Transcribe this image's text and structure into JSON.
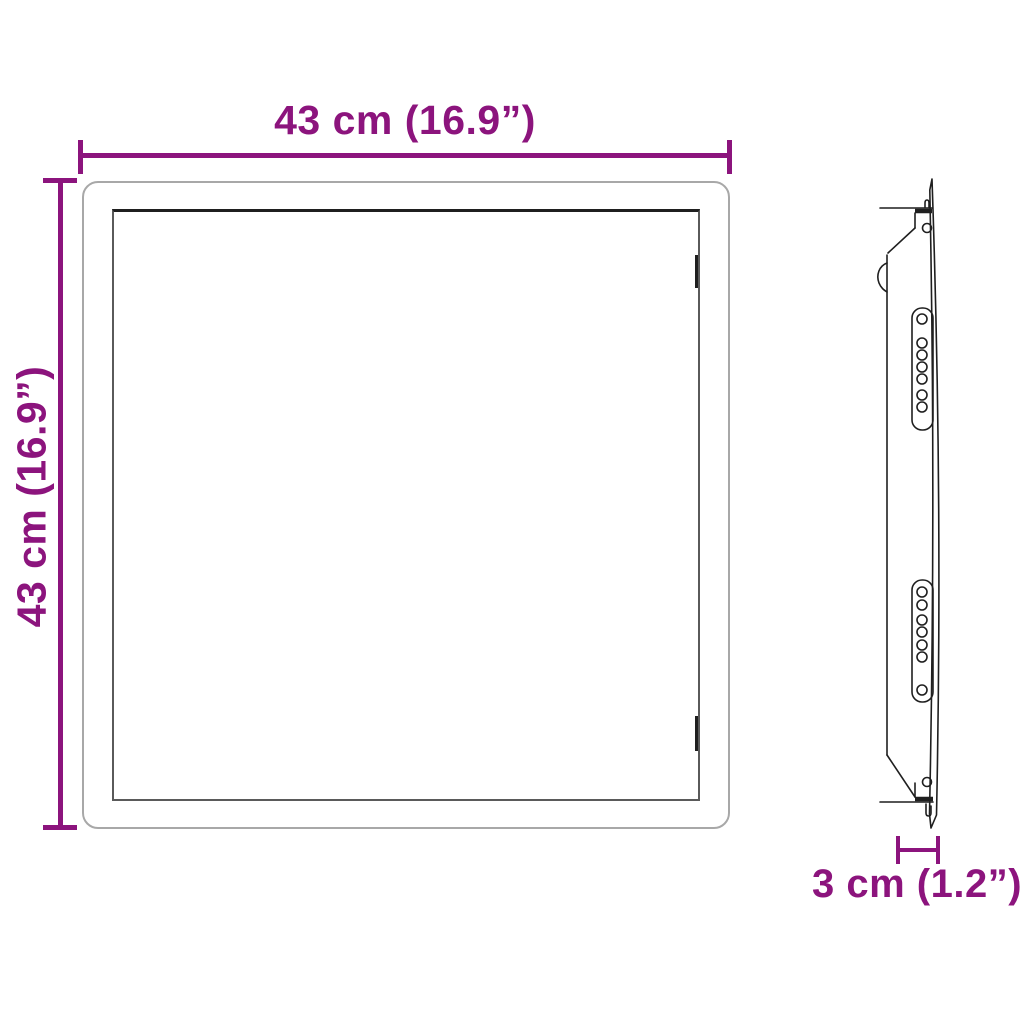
{
  "title": "Wall panel dimension diagram",
  "colors": {
    "dimension": "#8C147D",
    "outer_frame": "#A8A8A8",
    "inner_frame": "#5A5A5A",
    "drawing_line": "#1F1F1F",
    "background": "#FFFFFF"
  },
  "dimensions": {
    "width": {
      "label": "43 cm (16.9”)"
    },
    "height": {
      "label": "43 cm (16.9”)"
    },
    "depth": {
      "label": "3 cm (1.2”)"
    }
  }
}
